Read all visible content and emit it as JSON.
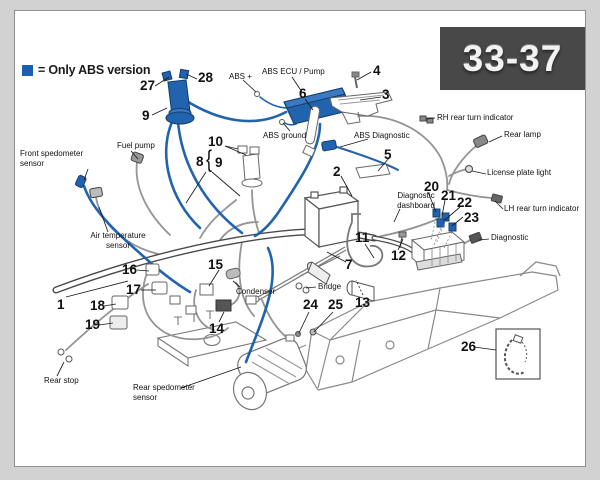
{
  "page_code": "33-37",
  "legend": {
    "text": "= Only ABS version",
    "swatch_color": "#1d5fae"
  },
  "colors": {
    "abs_blue": "#2163ae",
    "code_box_bg": "#484848",
    "code_box_text": "#f2f2f2",
    "page_bg": "#ffffff",
    "outer_bg": "#d2d2d2"
  },
  "part_labels": {
    "front_speedo": "Front spedometer\nsensor",
    "fuel_pump": "Fuel pump",
    "air_temp": "Air temperature\nsensor",
    "abs_plus": "ABS +",
    "abs_ecu": "ABS ECU / Pump",
    "abs_ground": "ABS ground",
    "abs_diag": "ABS Diagnostic",
    "rh_rear_turn": "RH rear turn indicator",
    "rear_lamp": "Rear lamp",
    "license_plate": "License plate light",
    "lh_rear_turn": "LH rear turn indicator",
    "diag_dashboard": "Diagnostic\ndashboard",
    "diagnostic": "Diagnostic",
    "condenser": "Condenser",
    "bridge": "Bridge",
    "rear_stop": "Rear stop",
    "rear_speedo": "Rear spedometer\nsensor"
  },
  "callouts": {
    "c1": "1",
    "c2": "2",
    "c3": "3",
    "c4": "4",
    "c5": "5",
    "c6": "6",
    "c7": "7",
    "c8": "8",
    "c8_bracket": "{",
    "c9_top": "9",
    "c9": "9",
    "c10": "10",
    "c11": "11",
    "c12": "12",
    "c13": "13",
    "c14": "14",
    "c15": "15",
    "c16": "16",
    "c17": "17",
    "c18": "18",
    "c19": "19",
    "c20": "20",
    "c21": "21",
    "c22": "22",
    "c23": "23",
    "c24": "24",
    "c25": "25",
    "c26": "26",
    "c27": "27",
    "c28": "28"
  }
}
